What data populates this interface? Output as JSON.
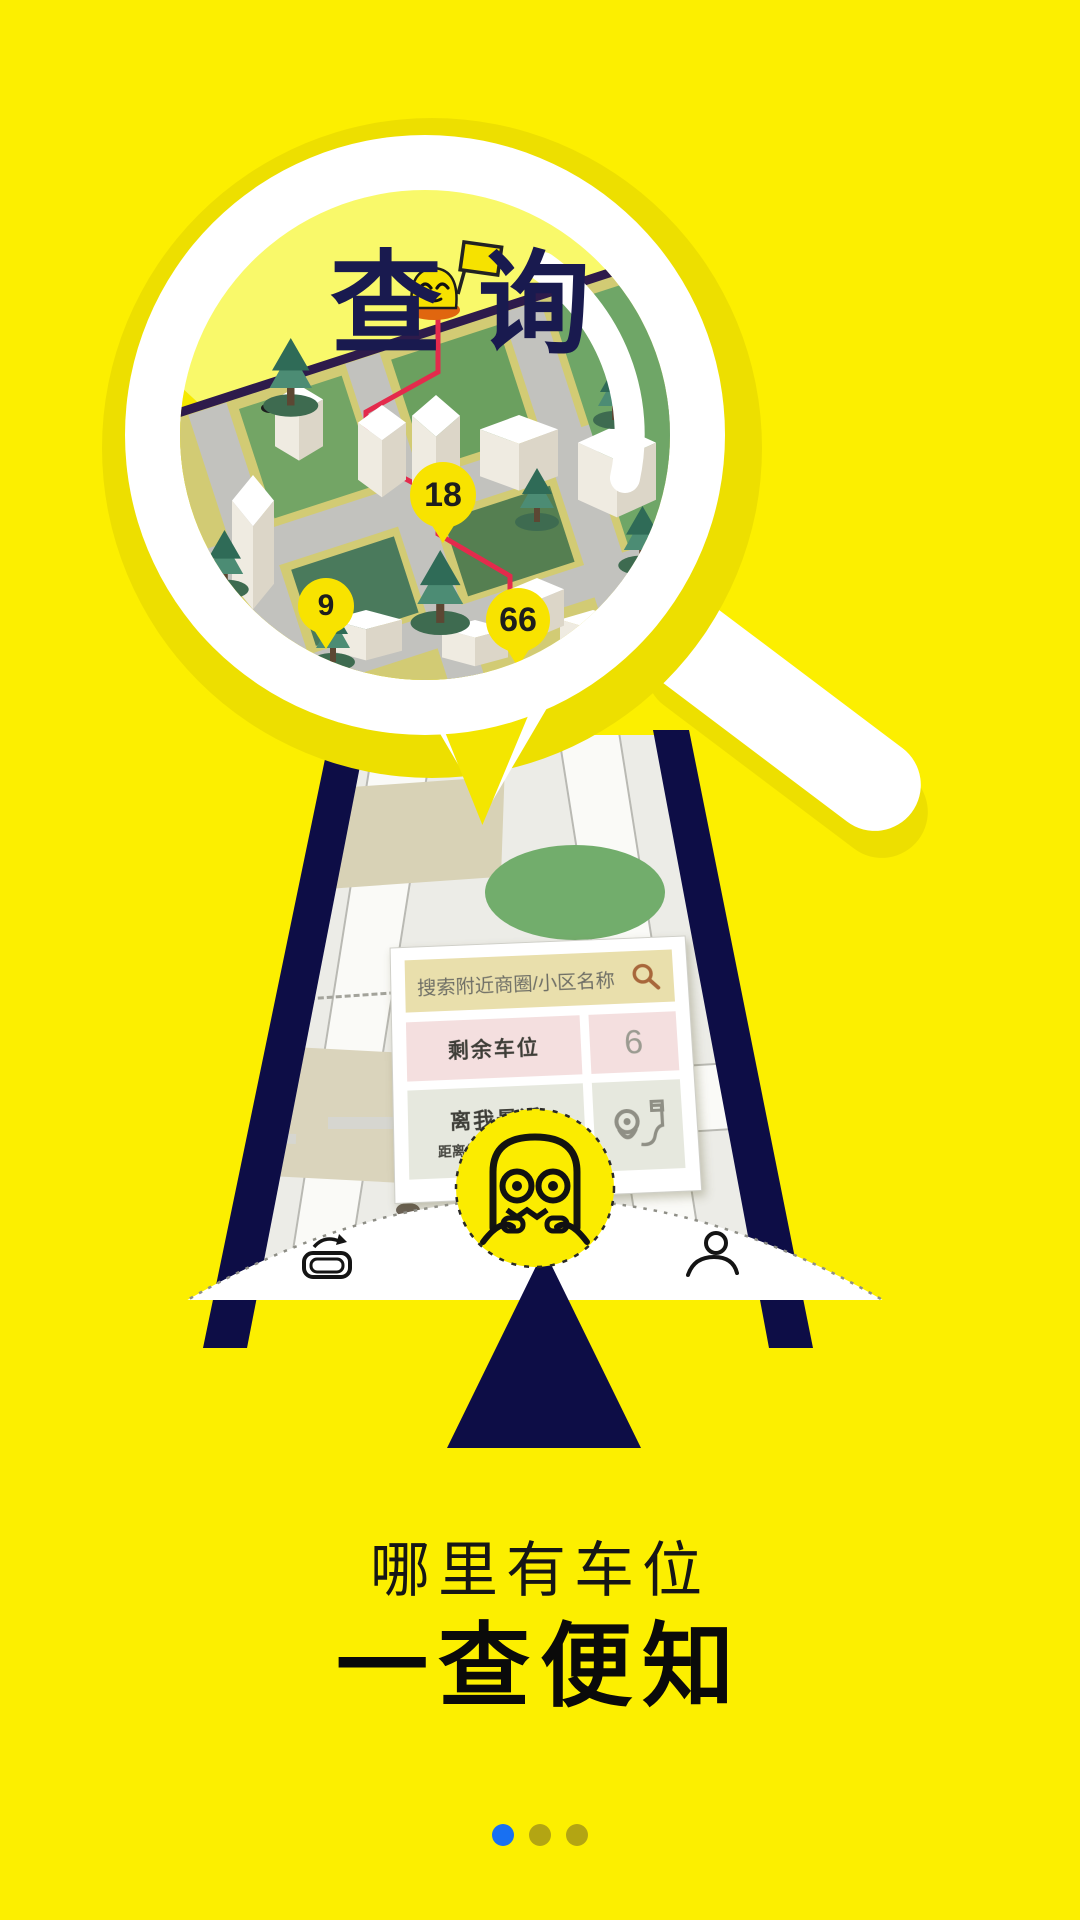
{
  "onboarding": {
    "title": "查询",
    "map_pins": [
      {
        "label": "18"
      },
      {
        "label": "9"
      },
      {
        "label": "66"
      }
    ],
    "phone_card": {
      "search_placeholder": "搜索附近商圈/小区名称",
      "rows": [
        {
          "label": "剩余车位",
          "value": "6"
        },
        {
          "label": "离我最近",
          "sublabel": "距离您的位置101米"
        }
      ]
    },
    "caption_line1": "哪里有车位",
    "caption_line2": "一查便知",
    "pagination": {
      "total": 3,
      "active_index": 0
    }
  },
  "icons": {
    "search": "magnifier",
    "route": "pin-with-route-flag",
    "car": "car-history",
    "user": "person",
    "mascot": "owl-face",
    "arrow": "up-triangle"
  },
  "colors": {
    "background": "#FCEF00",
    "navy": "#0D0D46",
    "lens_fill": "#F9F96A",
    "ring_shadow": "#EDDF00",
    "pin_yellow": "#F8E300",
    "route_red": "#E42A4C",
    "active_dot": "#1870F2",
    "inactive_dot": "#B3A513"
  }
}
